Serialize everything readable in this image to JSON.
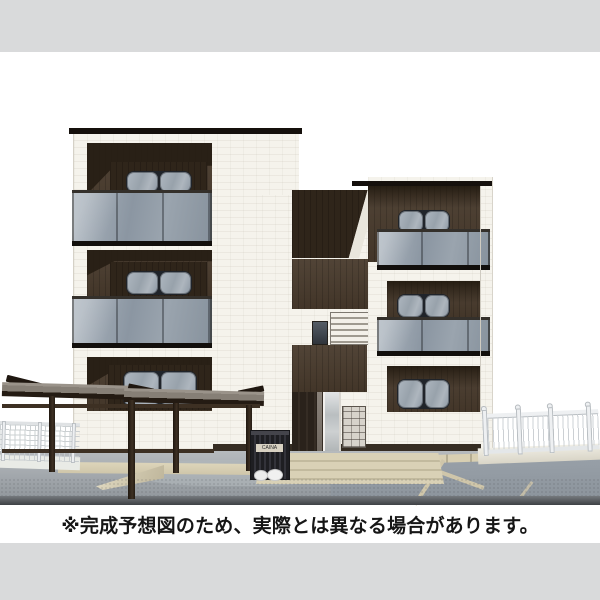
{
  "disclaimer": {
    "text": "※完成予想図のため、実際とは異なる場合があります。"
  },
  "trash_box": {
    "label": "CAINA"
  },
  "colors": {
    "band": "#d9dadb",
    "ink": "#161616",
    "wall": "#f5f3ec",
    "wood": "#483a2c",
    "wood_dark": "#2f251a",
    "roof": "#15100c",
    "glass_hi": "#aeb7c0",
    "glass_lo": "#8b96a2",
    "canopy": "#867f76",
    "post": "#3d3023",
    "ground_hi": "#b6babd",
    "ground_lo": "#8d9398",
    "parking": "#8c949c",
    "paving": "#cfc6aa",
    "fence": "#eef0f2",
    "trash": "#26262a"
  }
}
